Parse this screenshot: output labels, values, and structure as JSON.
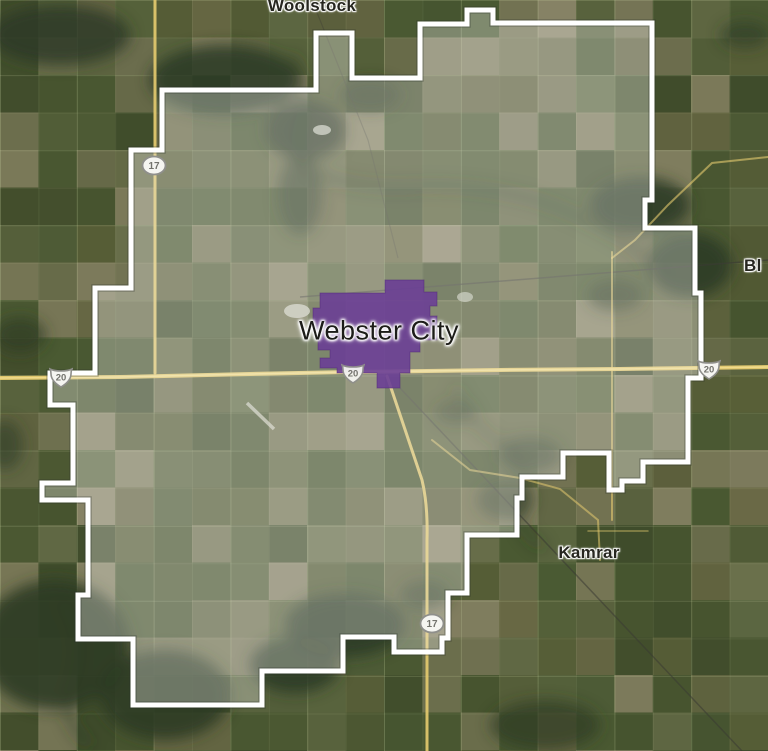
{
  "map": {
    "labels": {
      "woolstock": "Woolstock",
      "webster_city": "Webster City",
      "kamrar": "Kamrar",
      "east_partial": "Bl"
    },
    "shields": {
      "ia17_north": "17",
      "ia17_south": "17",
      "us20_west": "20",
      "us20_city": "20",
      "us20_east": "20"
    },
    "colors": {
      "district_outline": "#ffffff",
      "city_highlight": "#6b3f96",
      "highway_yellow": "#e6cb6f"
    }
  }
}
